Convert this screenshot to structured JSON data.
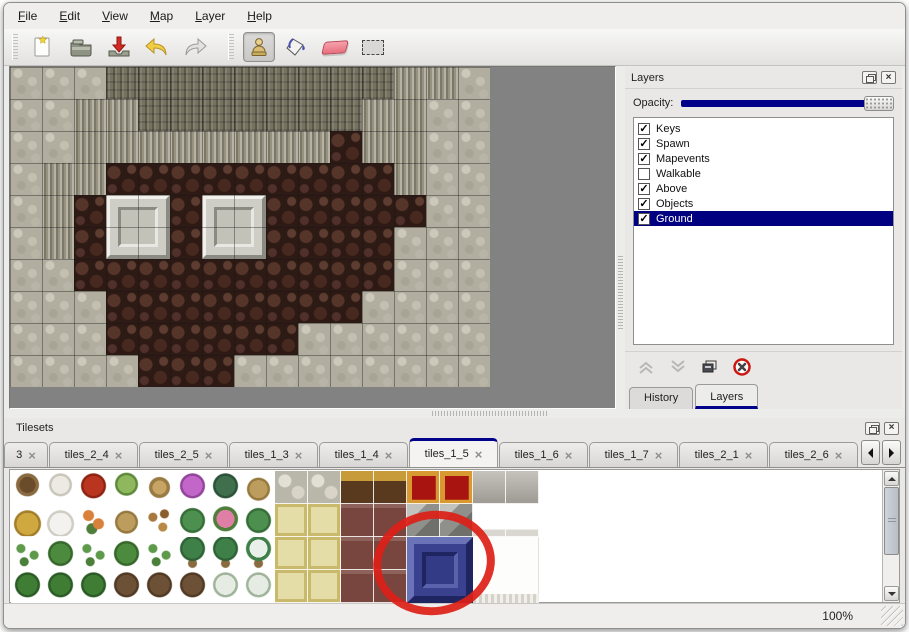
{
  "menu": {
    "items": [
      "File",
      "Edit",
      "View",
      "Map",
      "Layer",
      "Help"
    ]
  },
  "toolbar": {
    "buttons": [
      {
        "name": "new-file-button",
        "icon": "new-document-icon"
      },
      {
        "name": "open-button",
        "icon": "open-folder-icon"
      },
      {
        "name": "save-button",
        "icon": "save-download-icon"
      },
      {
        "name": "undo-button",
        "icon": "undo-arrow-icon"
      },
      {
        "name": "redo-button",
        "icon": "redo-arrow-icon"
      },
      {
        "name": "stamp-tool-button",
        "icon": "stamp-person-icon",
        "active": true
      },
      {
        "name": "fill-tool-button",
        "icon": "paint-bucket-icon"
      },
      {
        "name": "eraser-tool-button",
        "icon": "eraser-icon"
      },
      {
        "name": "select-tool-button",
        "icon": "selection-rectangle-icon"
      }
    ]
  },
  "map": {
    "tile_size": 32,
    "rows": [
      "SSSTTTTTTTTTCCS",
      "SSCCTTTTTTTCCSS",
      "SSCCCCCCCCFCCSS",
      "SCCFFFFFFFFFCSS",
      "SCFFFFFFFFFFFSS",
      "SCFFFFFFFFFFSSS",
      "SSFFFFFFFFFFSSS",
      "SSSFFFFFFFFSSSS",
      "SSSFFFFFFSSSSSS",
      "SSSSFFFSSSSSSSS"
    ],
    "palette": {
      "S": "radial-gradient(circle at 25% 20%, #ccc9bb 0 4px, rgba(0,0,0,0) 5px), radial-gradient(circle at 70% 45%, #c3c0b1 0 4px, rgba(0,0,0,0) 5px), radial-gradient(circle at 35% 70%, #a7a495 0 4px, rgba(0,0,0,0) 5px), radial-gradient(circle at 80% 85%, #b8b5a6 0 4px, rgba(0,0,0,0) 5px) #b1ae9f",
      "T": "repeating-linear-gradient(90deg, rgba(0,0,0,0.22) 0 2px, rgba(255,255,255,0.10) 2px 4px, rgba(0,0,0,0) 4px 7px), repeating-linear-gradient(0deg, rgba(0,0,0,0.15) 0 2px, rgba(0,0,0,0) 2px 8px) #767260",
      "C": "repeating-linear-gradient(90deg, rgba(255,255,255,0.30) 0 2px, rgba(0,0,0,0.18) 2px 4px, rgba(0,0,0,0) 4px 6px) #96927f",
      "F": "radial-gradient(circle at 25% 30%, #55352a 0 6px, rgba(0,0,0,0) 7px), radial-gradient(circle at 70% 70%, #47291f 0 6px, rgba(0,0,0,0) 7px), radial-gradient(circle at 80% 20%, #5d3d30 0 4px, rgba(0,0,0,0) 5px), radial-gradient(circle at 20% 80%, #50302a 0 4px, rgba(0,0,0,0) 5px) #2e1a14"
    },
    "platforms": [
      {
        "x": 96,
        "y": 128
      },
      {
        "x": 192,
        "y": 128
      }
    ]
  },
  "layers_panel": {
    "title": "Layers",
    "opacity_label": "Opacity:",
    "accent_color": "#00008b",
    "layers": [
      {
        "name": "Keys",
        "checked": true,
        "selected": false
      },
      {
        "name": "Spawn",
        "checked": true,
        "selected": false
      },
      {
        "name": "Mapevents",
        "checked": true,
        "selected": false
      },
      {
        "name": "Walkable",
        "checked": false,
        "selected": false
      },
      {
        "name": "Above",
        "checked": true,
        "selected": false
      },
      {
        "name": "Objects",
        "checked": true,
        "selected": false
      },
      {
        "name": "Ground",
        "checked": true,
        "selected": true
      }
    ],
    "buttons": [
      "move-layer-up",
      "move-layer-down",
      "duplicate-layer",
      "delete-layer"
    ],
    "tabs": [
      {
        "label": "History",
        "active": false
      },
      {
        "label": "Layers",
        "active": true
      }
    ]
  },
  "tilesets_panel": {
    "title": "Tilesets",
    "close_glyph": "×",
    "tabs": [
      {
        "label": "3",
        "active": false
      },
      {
        "label": "tiles_2_4",
        "active": false
      },
      {
        "label": "tiles_2_5",
        "active": false
      },
      {
        "label": "tiles_1_3",
        "active": false
      },
      {
        "label": "tiles_1_4",
        "active": false
      },
      {
        "label": "tiles_1_5",
        "active": true
      },
      {
        "label": "tiles_1_6",
        "active": false
      },
      {
        "label": "tiles_1_7",
        "active": false
      },
      {
        "label": "tiles_2_1",
        "active": false
      },
      {
        "label": "tiles_2_6",
        "active": false
      }
    ],
    "tileset": {
      "tile_size": 33,
      "rows": [
        "awrukpfdSSTTRRYY",
        "hnodlLqLEEMMKKWW",
        "gBgBgPPNEEMMUUWW",
        "cccGGGssEEMMUUWW"
      ],
      "palette": {
        "a": "radial-gradient(circle at 50% 42%, #6b4c2a 0 8px, #8a6a40 8px 11px, rgba(0,0,0,0) 12px) #fff",
        "w": "radial-gradient(circle at 50% 42%, #eceae2 0 9px, #c9c6ba 9px 11px, rgba(0,0,0,0) 12px) #fff",
        "r": "radial-gradient(circle at 50% 45%, #b9351f 0 10px, #8f2413 10px 12px, rgba(0,0,0,0) 13px) #fff",
        "u": "radial-gradient(circle at 50% 40%, #8fb75e 0 9px, #5f8a3c 9px 11px, rgba(0,0,0,0) 12px) #fff",
        "k": "radial-gradient(circle at 50% 50%, #c7a463 0 7px, #9a7a43 7px 10px, rgba(0,0,0,0) 11px) #fff",
        "p": "radial-gradient(circle at 50% 45%, #c267c9 0 10px, #93459a 10px 12px, rgba(0,0,0,0) 13px) #fff",
        "f": "radial-gradient(circle at 50% 45%, #3f6f4c 0 10px, #2c5237 10px 12px, rgba(0,0,0,0) 13px) #fff",
        "d": "radial-gradient(circle at 50% 55%, #bd9d5e 0 9px, #96793f 9px 11px, rgba(0,0,0,0) 12px) #fff",
        "h": "radial-gradient(circle at 50% 60%, #cfa93f 0 11px, #a37f2a 11px 13px, rgba(0,0,0,0) 14px) #fff",
        "n": "radial-gradient(circle at 50% 60%, #f3f2ee 0 11px, #cfcdc4 11px 13px, rgba(0,0,0,0) 14px) #fff",
        "o": "radial-gradient(circle at 35% 35%, #d9803a 0 5px, rgba(0,0,0,0) 6px), radial-gradient(circle at 65% 60%, #d9803a 0 5px, rgba(0,0,0,0) 6px), radial-gradient(circle at 45% 75%, #4f7d3a 0 5px, rgba(0,0,0,0) 6px) #fff",
        "l": "radial-gradient(circle at 30% 40%, #a8793c 0 4px, rgba(0,0,0,0) 5px), radial-gradient(circle at 65% 30%, #8a5f2b 0 4px, rgba(0,0,0,0) 5px), radial-gradient(circle at 60% 70%, #b98a47 0 4px, rgba(0,0,0,0) 5px) #fff",
        "L": "radial-gradient(circle at 50% 50%, #4d8f4f 0 10px, #356e37 10px 12px, rgba(0,0,0,0) 13px) #fff",
        "q": "radial-gradient(circle at 50% 45%, #df7fa5 0 9px, #4f7d3a 9px 12px, rgba(0,0,0,0) 13px) #fff",
        "g": "radial-gradient(circle at 30% 35%, #5d9a4a 0 4px, rgba(0,0,0,0) 5px), radial-gradient(circle at 70% 55%, #5d9a4a 0 4px, rgba(0,0,0,0) 5px), radial-gradient(circle at 40% 75%, #4a8039 0 4px, rgba(0,0,0,0) 5px) #fff",
        "B": "radial-gradient(circle at 50% 50%, #4c8a3d 0 10px, #36682a 10px 12px, rgba(0,0,0,0) 13px) #fff",
        "P": "radial-gradient(circle at 50% 35%, #3f8049 0 10px, #2f6337 10px 12px, rgba(0,0,0,0) 13px), radial-gradient(circle at 50% 80%, #8a6a3f 0 4px, rgba(0,0,0,0) 5px) #fff",
        "N": "radial-gradient(circle at 50% 35%, #e9efe9 0 9px, #3f8049 9px 12px, rgba(0,0,0,0) 13px), radial-gradient(circle at 50% 80%, #8a6a3f 0 4px, rgba(0,0,0,0) 5px) #fff",
        "c": "radial-gradient(circle at 50% 45%, #3f7d35 0 10px, #2c5c25 10px 12px, rgba(0,0,0,0) 13px) #fff",
        "G": "radial-gradient(circle at 50% 45%, #6d5136 0 10px, #523a24 10px 12px, rgba(0,0,0,0) 13px) #fff",
        "s": "radial-gradient(circle at 50% 45%, #e6ebe4 0 10px, #9fb49a 10px 12px, rgba(0,0,0,0) 13px) #fff",
        "S": "radial-gradient(circle at 30% 30%, #e2dfd4 0 6px, rgba(0,0,0,0) 7px), radial-gradient(circle at 70% 65%, #d8d5c8 0 6px, rgba(0,0,0,0) 7px) #b9b6aa",
        "T": "linear-gradient(#c89b3a 0 30%, #5a3a1e 30% 100%)",
        "R": "linear-gradient(#a81510 0 100%) center / 72% 72% no-repeat, #d89a30",
        "Y": "linear-gradient(rgba(255,255,255,0.25), rgba(0,0,0,0.12)) #b2afa6",
        "E": "linear-gradient(#e4dda8 0 100%) center / 80% 80% no-repeat, #c9b96a",
        "M": "linear-gradient(rgba(255,255,255,0.15) 0 12%, rgba(0,0,0,0) 12%) #78463e",
        "K": "linear-gradient(135deg, #c2c2bf 0 30%, #8f8f8b 30% 60%, #6f6f6b 60%) #9a9a96",
        "U": "linear-gradient(135deg, #555fa8 0 18%, #2e3578 82%, #1f2560) #3a4190",
        "W": "linear-gradient(#ffffff 0 78%, #d9d7d0 78% 100%) #fff"
      },
      "highlight_tile": {
        "x": 396,
        "y": 66,
        "w": 66,
        "h": 66,
        "color": "#3a418f"
      },
      "white_big_tile": {
        "x": 462,
        "y": 66,
        "w": 66,
        "h": 66
      }
    },
    "annotation": {
      "shape": "red-circle",
      "color": "#dd2017"
    }
  },
  "statusbar": {
    "zoom_level": "100%"
  }
}
